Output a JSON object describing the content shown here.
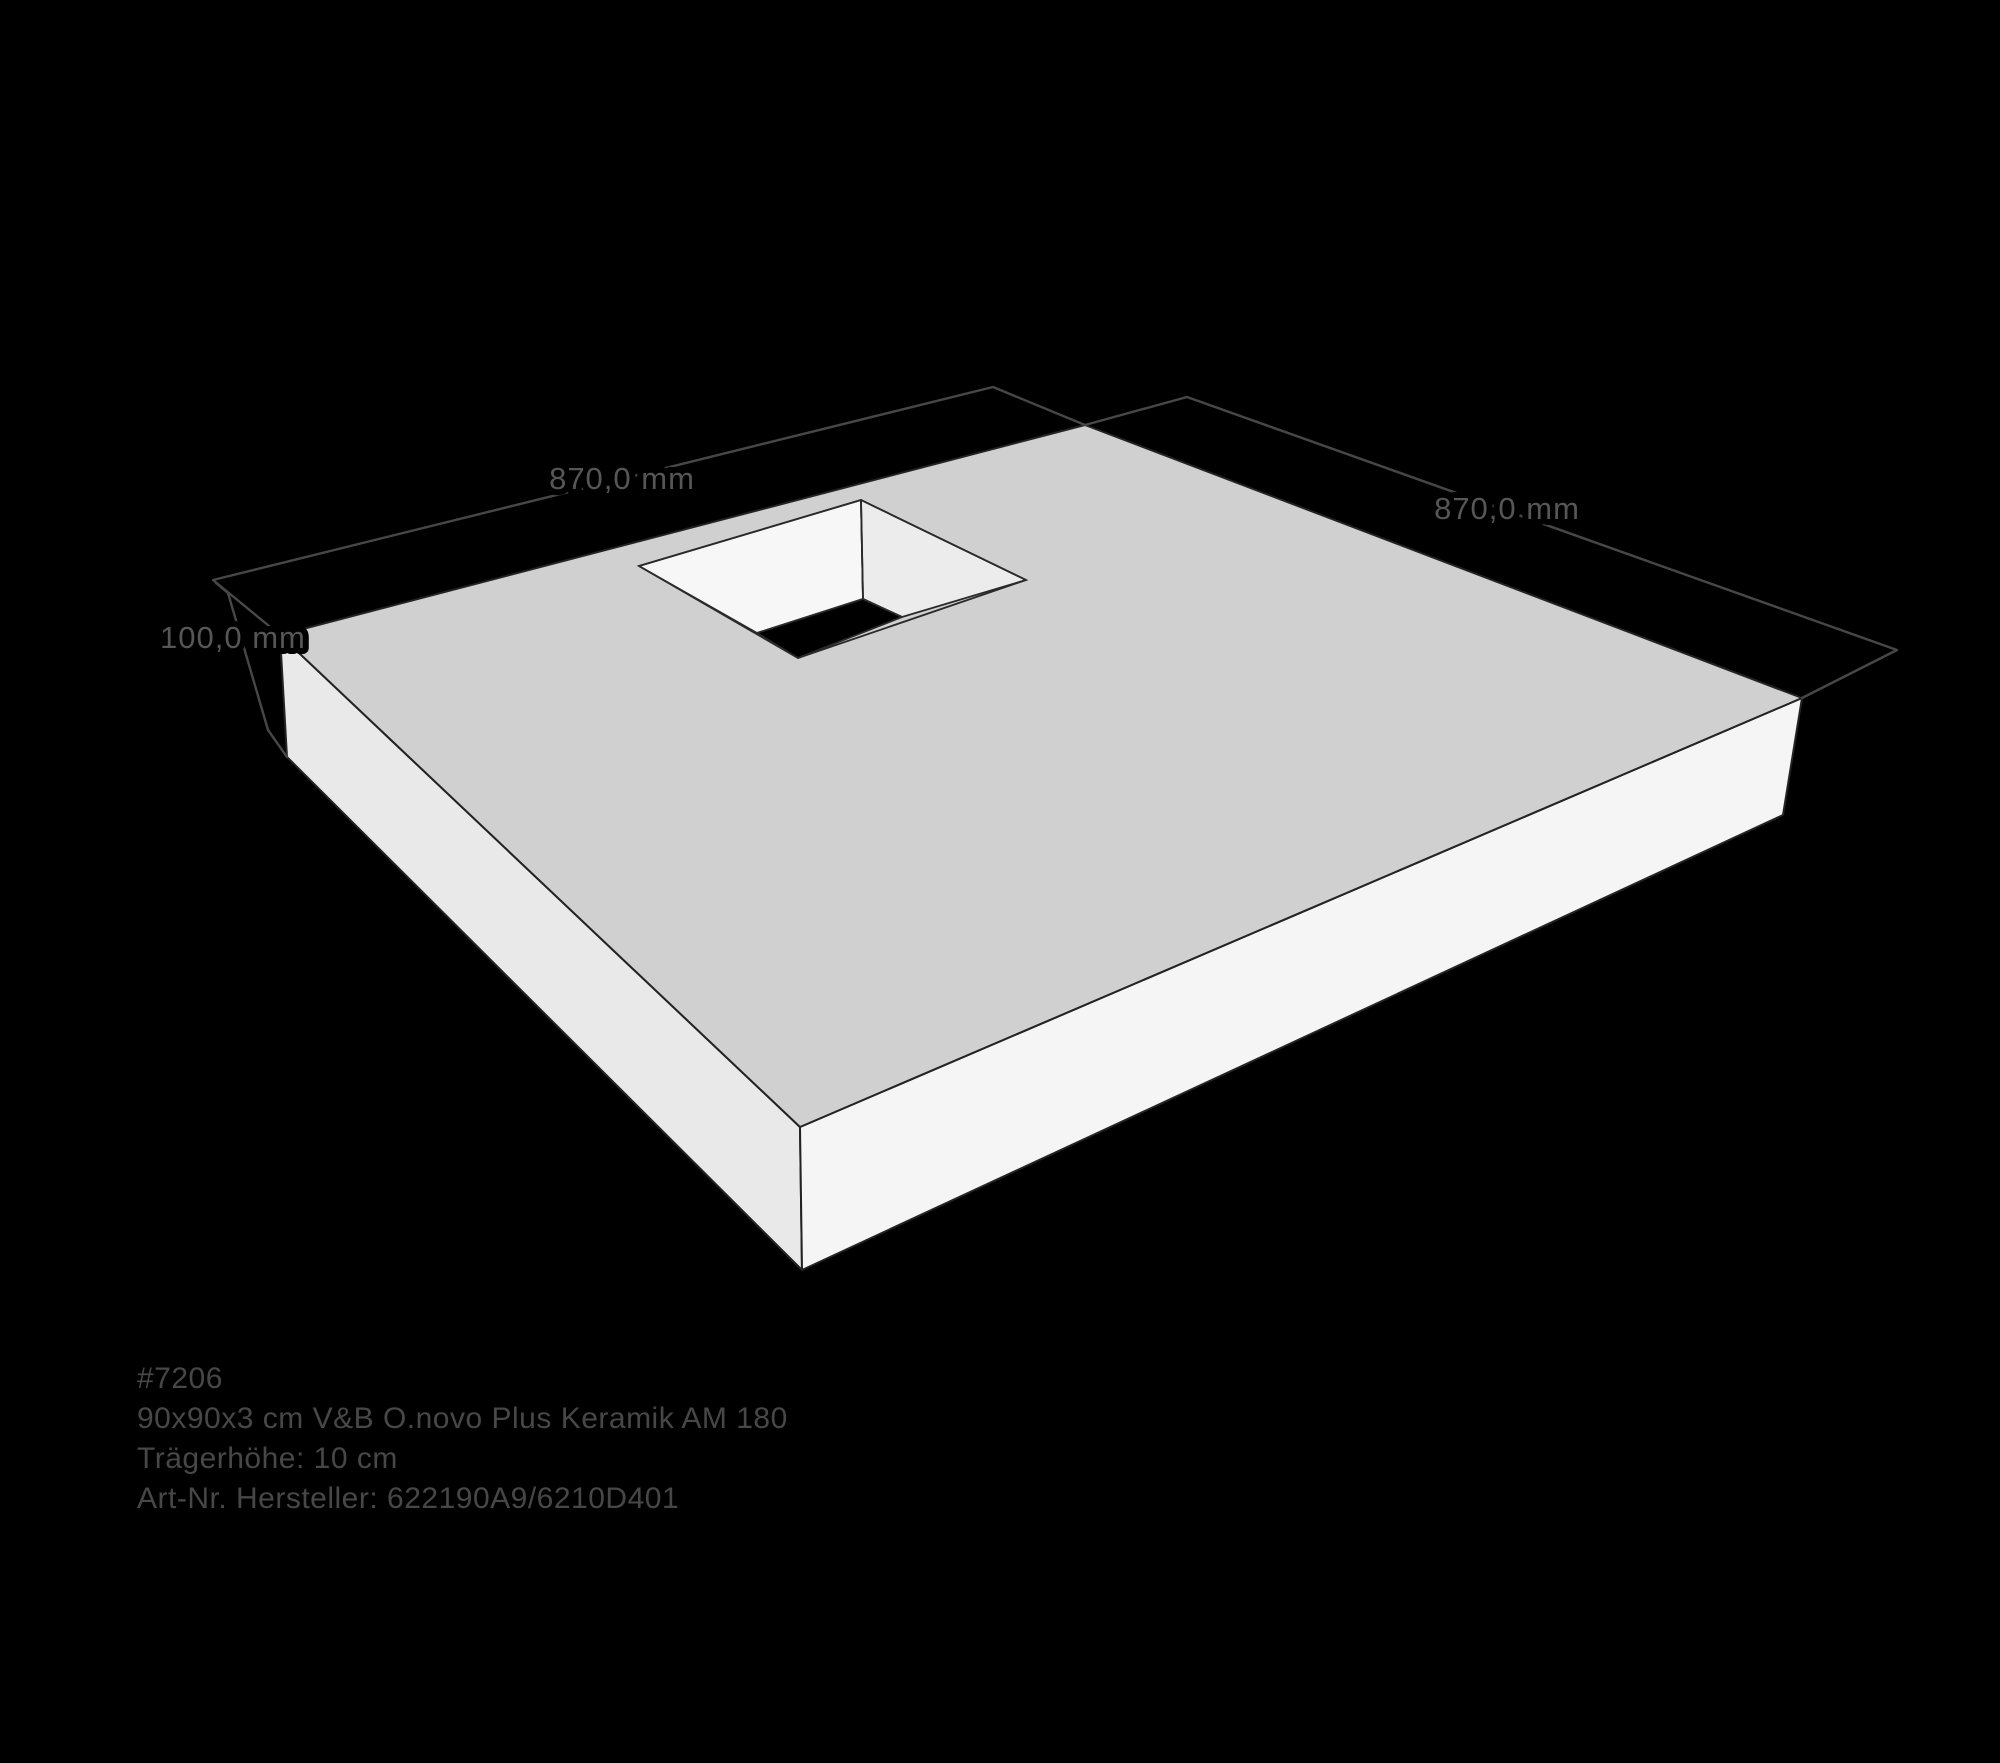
{
  "canvas": {
    "background": "#000000",
    "description": "3D CAD rendering of a square shower tray support with rectangular cutout, dimensioned"
  },
  "scene": {
    "colors": {
      "top_face": "#d0d0d0",
      "front_left_face": "#e9e9e9",
      "front_right_face": "#f5f5f5",
      "hole_left_wall": "#f7f7f7",
      "hole_right_wall": "#ececec",
      "hole_opening": "#000000",
      "edge_stroke": "#232323",
      "dimension_stroke": "#474747",
      "dimension_text_color": "#565656",
      "info_text_color": "#474747"
    },
    "dimensions": {
      "left_width": "870,0 mm",
      "right_width": "870,0 mm",
      "height": "100,0 mm"
    }
  },
  "info_block": {
    "line1": "#7206",
    "line2": "90x90x3 cm V&B O.novo Plus Keramik AM 180",
    "line3": "Trägerhöhe: 10 cm",
    "line4": "Art-Nr. Hersteller: 622190A9/6210D401"
  }
}
